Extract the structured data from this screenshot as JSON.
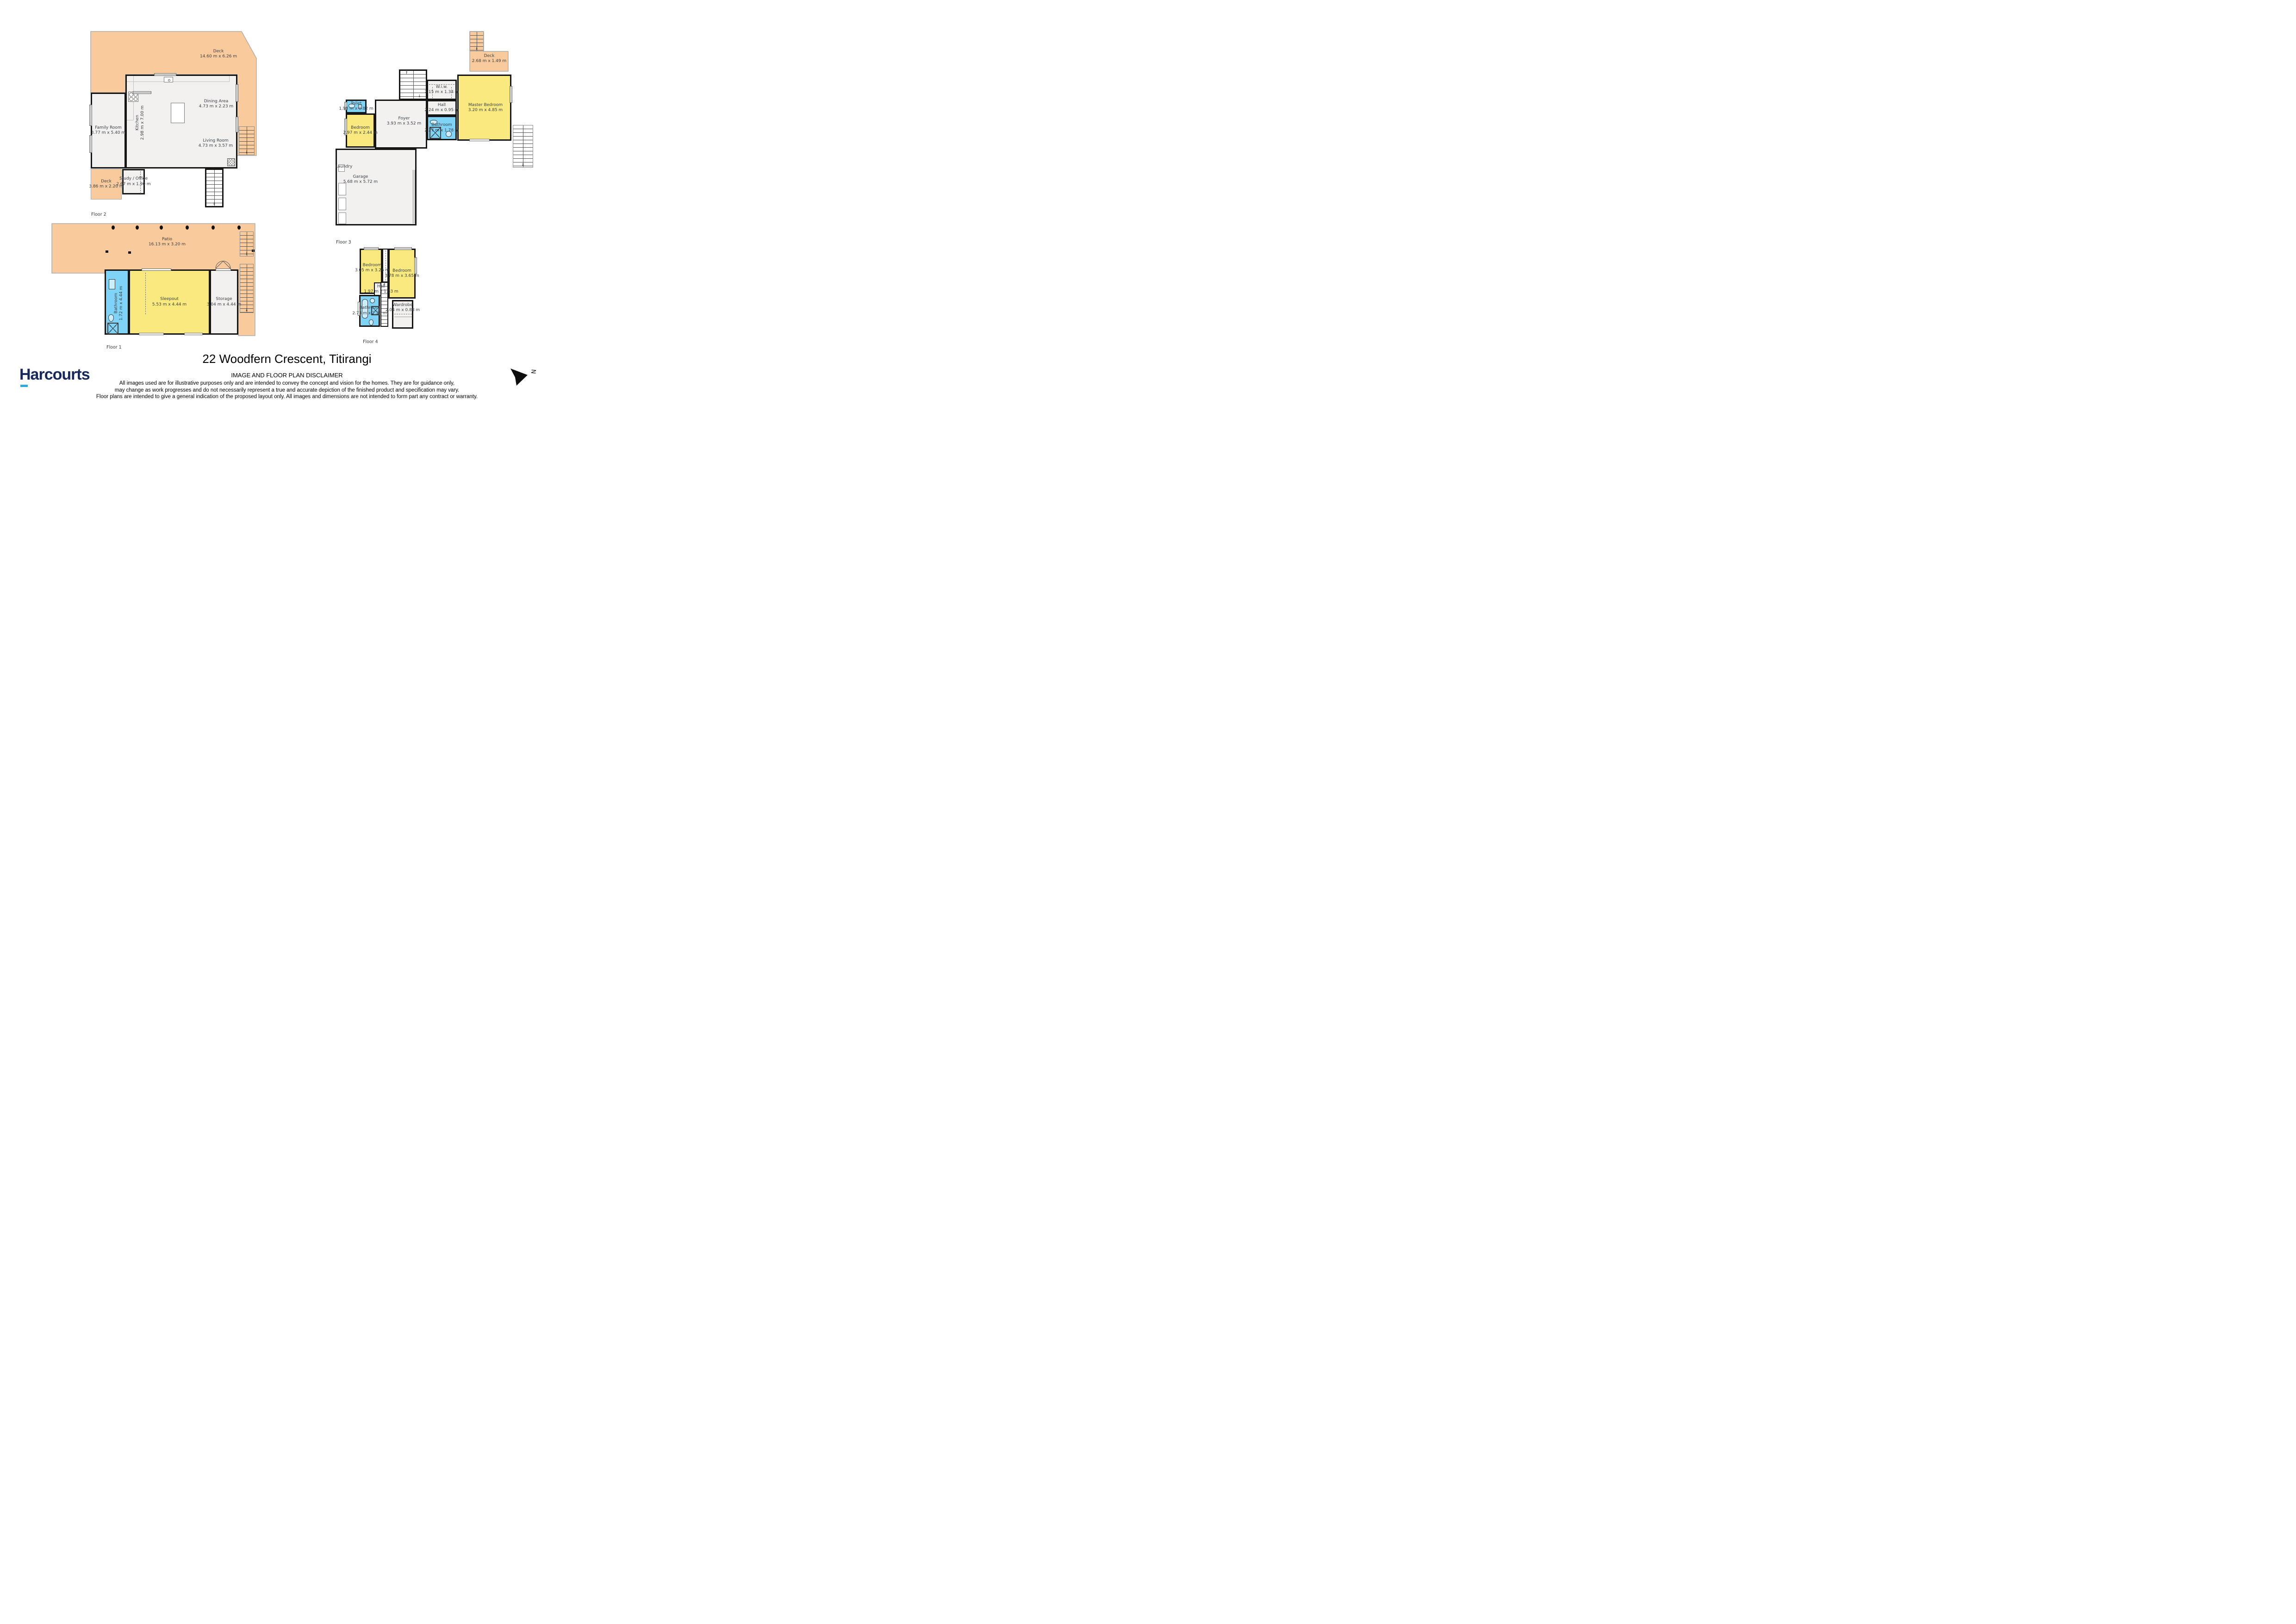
{
  "page": {
    "title": "22 Woodfern Crescent, Titirangi"
  },
  "brand": {
    "name": "Harcourts"
  },
  "compass": {
    "label": "N"
  },
  "icons": {
    "stairs_down": "↓",
    "stairs_up": "↑"
  },
  "colors": {
    "wall": "#161616",
    "room": "#F2F1F0",
    "bed": "#F9E97E",
    "wet": "#7ED3F7",
    "deck": "#F9CA9C"
  },
  "disclaimer": {
    "heading": "IMAGE AND FLOOR PLAN DISCLAIMER",
    "line1": "All images used are for illustrative purposes only and are intended to convey the concept and vision for the homes. They are for guidance only,",
    "line2": "may change as work progresses and do not necessarily represent a true and accurate depiction of the finished product and specification may vary.",
    "line3": "Floor plans are intended to give a general indication of the proposed layout only. All images and dimensions are not intended to form part any contract or warranty."
  },
  "floors": {
    "floor1": {
      "label": "Floor 1",
      "rooms": {
        "patio": {
          "name": "Patio",
          "dims": "16.13 m x 3.20 m"
        },
        "bathroom": {
          "name": "Bathroom",
          "dims": "1.72 m x 4.44 m"
        },
        "sleepout": {
          "name": "Sleepout",
          "dims": "5.53 m x 4.44 m"
        },
        "storage": {
          "name": "Storage",
          "dims": "3.04 m x 4.44 m"
        }
      }
    },
    "floor2": {
      "label": "Floor 2",
      "rooms": {
        "deck_large": {
          "name": "Deck",
          "dims": "14.60 m x 6.26 m"
        },
        "family_room": {
          "name": "Family Room",
          "dims": "3.77 m x 5.40 m"
        },
        "kitchen": {
          "name": "Kitchen",
          "dims": "2.98 m x 7.00 m"
        },
        "dining": {
          "name": "Dining Area",
          "dims": "4.73 m x 2.23 m"
        },
        "living": {
          "name": "Living Room",
          "dims": "4.73 m x 3.57 m"
        },
        "study": {
          "name": "Study / Office",
          "dims": "2.67 m x 1.90 m"
        },
        "deck_small": {
          "name": "Deck",
          "dims": "3.86 m x 2.20 m"
        }
      }
    },
    "floor3": {
      "label": "Floor 3",
      "rooms": {
        "deck": {
          "name": "Deck",
          "dims": "2.68 m x 1.49 m"
        },
        "master": {
          "name": "Master Bedroom",
          "dims": "3.20 m x 4.85 m"
        },
        "wiw": {
          "name": "W.i.w.",
          "dims": "2.15 m x 1.34 m"
        },
        "hall": {
          "name": "Hall",
          "dims": "2.24 m x 0.95 m"
        },
        "toilet": {
          "name": "Toilet",
          "dims": "1.98 m x 0.82 m"
        },
        "bedroom": {
          "name": "Bedroom",
          "dims": "2.97 m x 2.44 m"
        },
        "foyer": {
          "name": "Foyer",
          "dims": "3.93 m x 3.52 m"
        },
        "bathroom": {
          "name": "Bathroom",
          "dims": "2.27 m x 1.78 m"
        },
        "laundry": {
          "name": "Laundry"
        },
        "garage": {
          "name": "Garage",
          "dims": "5.68 m x 5.72 m"
        }
      }
    },
    "floor4": {
      "label": "Floor 4",
      "rooms": {
        "bedroom_left": {
          "name": "Bedroom",
          "dims": "3.05 m x 3.26 m"
        },
        "bedroom_right": {
          "name": "Bedroom",
          "dims": "3.78 m x 3.65 m"
        },
        "hall": {
          "name": "Hall",
          "dims": "1.97 m x 1.33 m"
        },
        "bathroom": {
          "name": "Bathroom",
          "dims": "2.73 m x 2.28 m"
        },
        "wardrobe": {
          "name": "Wardrobe",
          "dims": "2.04 m x 0.88 m"
        }
      }
    }
  }
}
